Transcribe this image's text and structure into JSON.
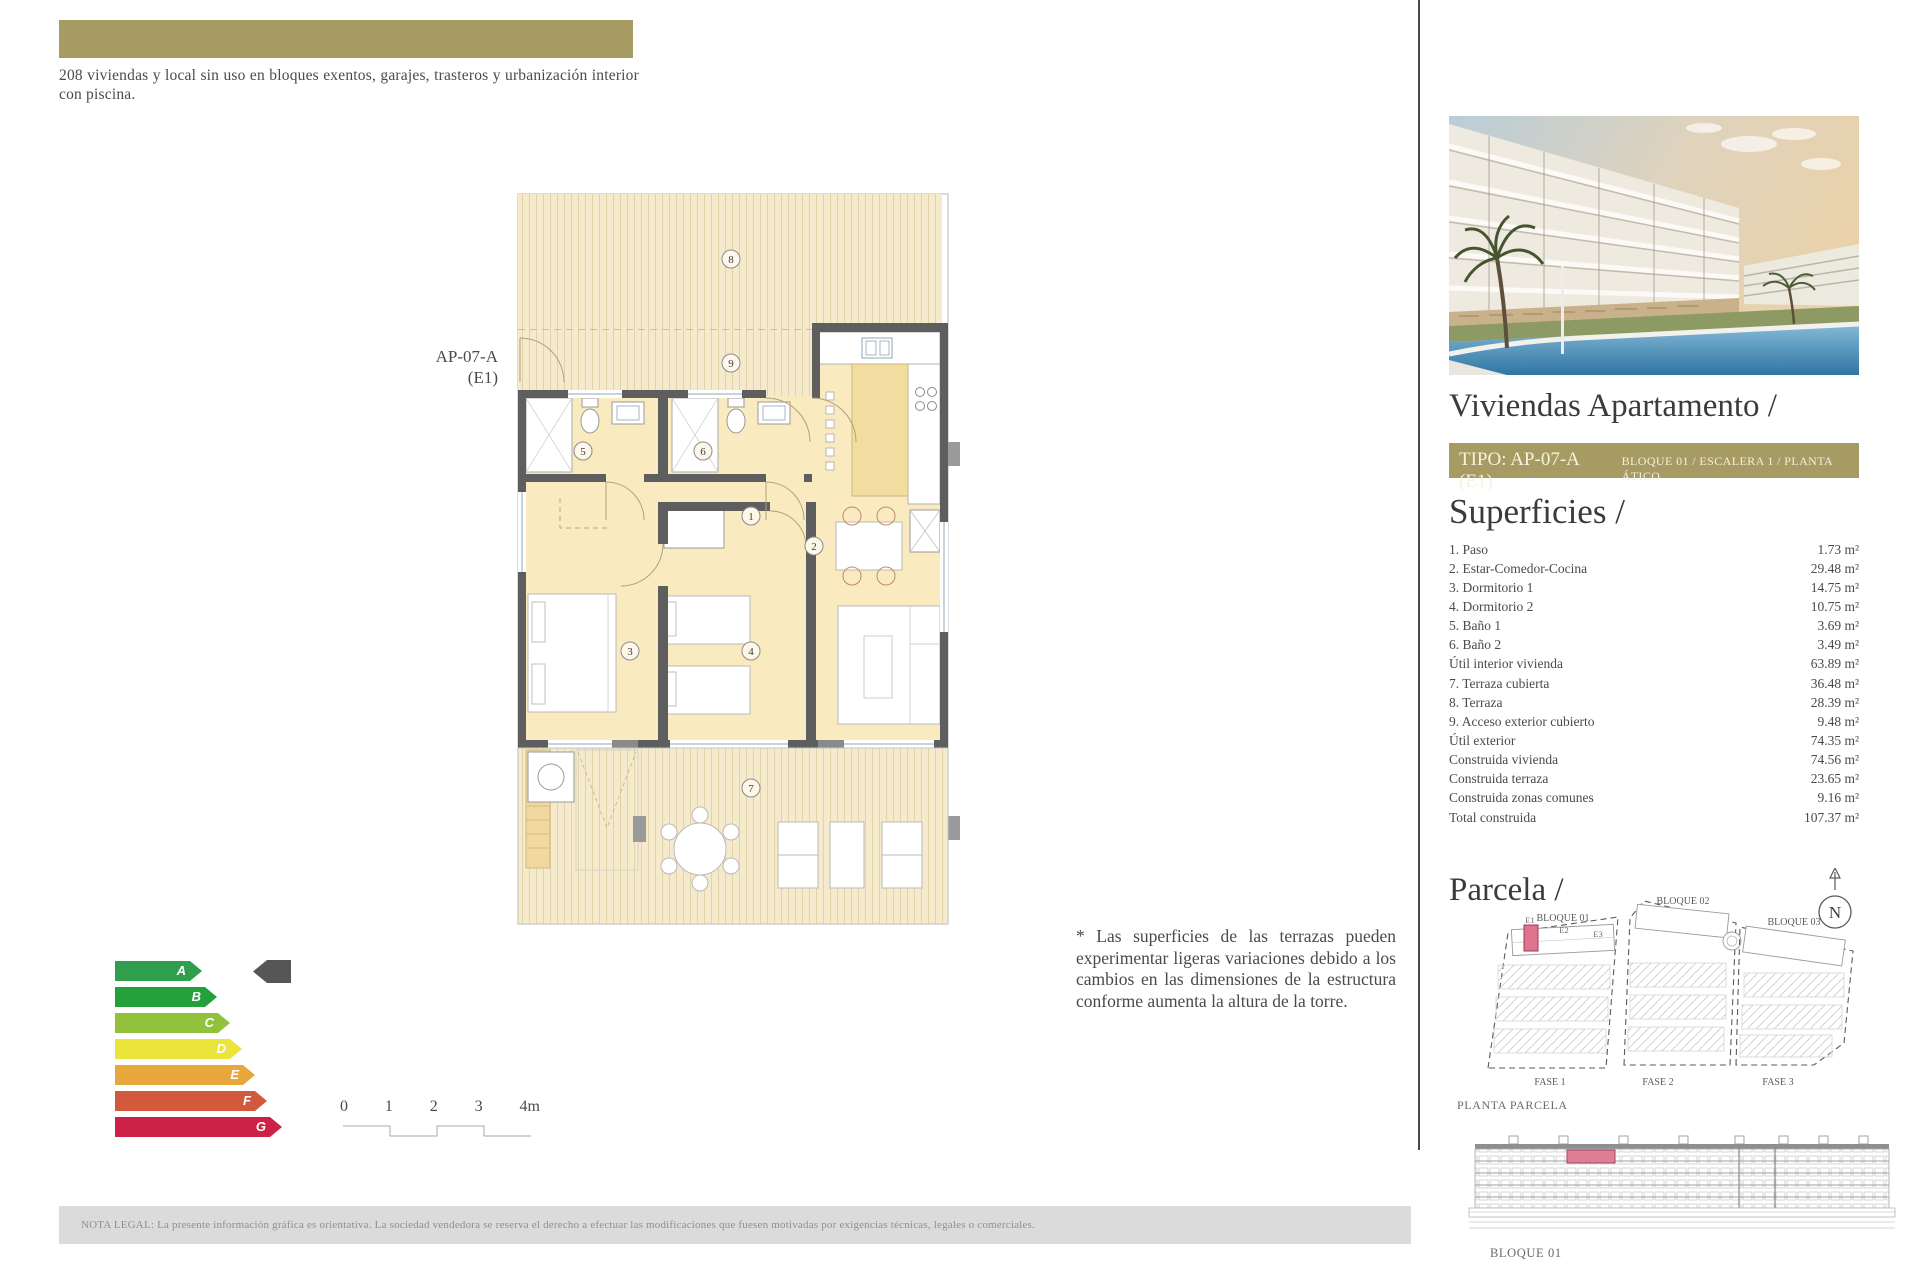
{
  "header": {
    "description": "208 viviendas y local sin uso en bloques exentos, garajes, trasteros y urbanización interior con piscina."
  },
  "floor_plan": {
    "unit_label_line1": "AP-07-A",
    "unit_label_line2": "(E1)",
    "rooms": [
      "1",
      "2",
      "3",
      "4",
      "5",
      "6",
      "7",
      "8",
      "9"
    ]
  },
  "energy_rating": {
    "selected": "A",
    "arrow_color": "#565656",
    "grades": [
      {
        "letter": "A",
        "color": "#2f9e4d"
      },
      {
        "letter": "B",
        "color": "#23a039"
      },
      {
        "letter": "C",
        "color": "#92c13e"
      },
      {
        "letter": "D",
        "color": "#ebe43a"
      },
      {
        "letter": "E",
        "color": "#e8a73d"
      },
      {
        "letter": "F",
        "color": "#d2593c"
      },
      {
        "letter": "G",
        "color": "#ce2147"
      }
    ]
  },
  "scale_bar": {
    "labels": [
      "0",
      "1",
      "2",
      "3",
      "4m"
    ]
  },
  "terrace_note": "* Las superficies de las terrazas pueden experimentar ligeras variaciones debido a los cambios en las dimensiones de la estructura conforme aumenta la altura de la torre.",
  "legal_note": "NOTA LEGAL: La presente información gráfica es orientativa. La sociedad vendedora se reserva el derecho a efectuar las modificaciones que fuesen motivadas por exigencias técnicas, legales o comerciales.",
  "sidebar": {
    "title": "Viviendas Apartamento /",
    "tipo_bar": {
      "tipo": "TIPO: AP-07-A (E1)",
      "details": "BLOQUE 01 / ESCALERA 1 / PLANTA ÁTICO"
    },
    "superficies": {
      "heading": "Superficies /",
      "rows": [
        {
          "label": "1. Paso",
          "value": "1.73 m²"
        },
        {
          "label": "2. Estar-Comedor-Cocina",
          "value": "29.48 m²"
        },
        {
          "label": "3. Dormitorio 1",
          "value": "14.75 m²"
        },
        {
          "label": "4. Dormitorio 2",
          "value": "10.75 m²"
        },
        {
          "label": "5. Baño 1",
          "value": "3.69 m²"
        },
        {
          "label": "6. Baño 2",
          "value": "3.49 m²"
        },
        {
          "label": "Útil interior vivienda",
          "value": "63.89 m²"
        },
        {
          "label": "7. Terraza cubierta",
          "value": "36.48 m²"
        },
        {
          "label": "8. Terraza",
          "value": "28.39 m²"
        },
        {
          "label": "9. Acceso exterior cubierto",
          "value": "9.48 m²"
        },
        {
          "label": "Útil exterior",
          "value": "74.35 m²"
        },
        {
          "label": "Construida vivienda",
          "value": "74.56 m²"
        },
        {
          "label": "Construida terraza",
          "value": "23.65 m²"
        },
        {
          "label": "Construida zonas comunes",
          "value": "9.16 m²"
        },
        {
          "label": "Total construida",
          "value": "107.37 m²"
        }
      ]
    },
    "parcela": {
      "heading": "Parcela /",
      "blocks": [
        "BLOQUE 01",
        "BLOQUE 02",
        "BLOQUE 03"
      ],
      "stairs": [
        "E1",
        "E2",
        "E3"
      ],
      "fases": [
        "FASE 1",
        "FASE 2",
        "FASE 3"
      ],
      "caption": "PLANTA PARCELA",
      "compass_letter": "N",
      "highlight_color": "#de7490"
    },
    "elevation": {
      "caption": "BLOQUE 01"
    }
  },
  "palette": {
    "olive": "#a69b63",
    "wall": "#5e5e5e",
    "floor": "#faeabf",
    "terrace_hatch": "#f5ebcc",
    "highlight_pink": "#de7490",
    "legal_bar": "#dbdbdb"
  }
}
